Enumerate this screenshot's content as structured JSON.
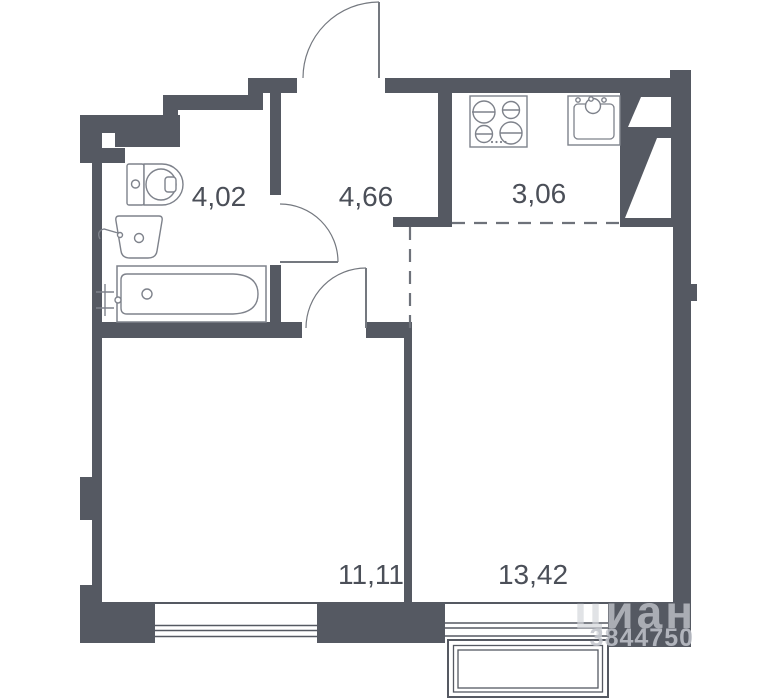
{
  "plan": {
    "type": "apartment-floor-plan",
    "background": "#ffffff"
  },
  "colors": {
    "wall": "#555962",
    "fixture_stroke": "#7e828b",
    "door_stroke": "#74787f",
    "dashed_divider": "#6e727a",
    "label_text": "#4b4f58",
    "watermark": "#c2c5cc"
  },
  "rooms": [
    {
      "id": "bathroom",
      "area_label": "4,02"
    },
    {
      "id": "hallway",
      "area_label": "4,66"
    },
    {
      "id": "kitchen",
      "area_label": "3,06"
    },
    {
      "id": "room-left",
      "area_label": "11,11"
    },
    {
      "id": "room-right",
      "area_label": "13,42"
    }
  ],
  "fixtures": [
    "toilet",
    "wash-basin",
    "bathtub",
    "bath-faucet",
    "stove",
    "kitchen-sink",
    "vent-shaft",
    "entrance-door",
    "bathroom-door",
    "room-door",
    "window-left",
    "window-right-bay"
  ],
  "watermark": {
    "logo": "циан",
    "listing_id": "3844750"
  }
}
